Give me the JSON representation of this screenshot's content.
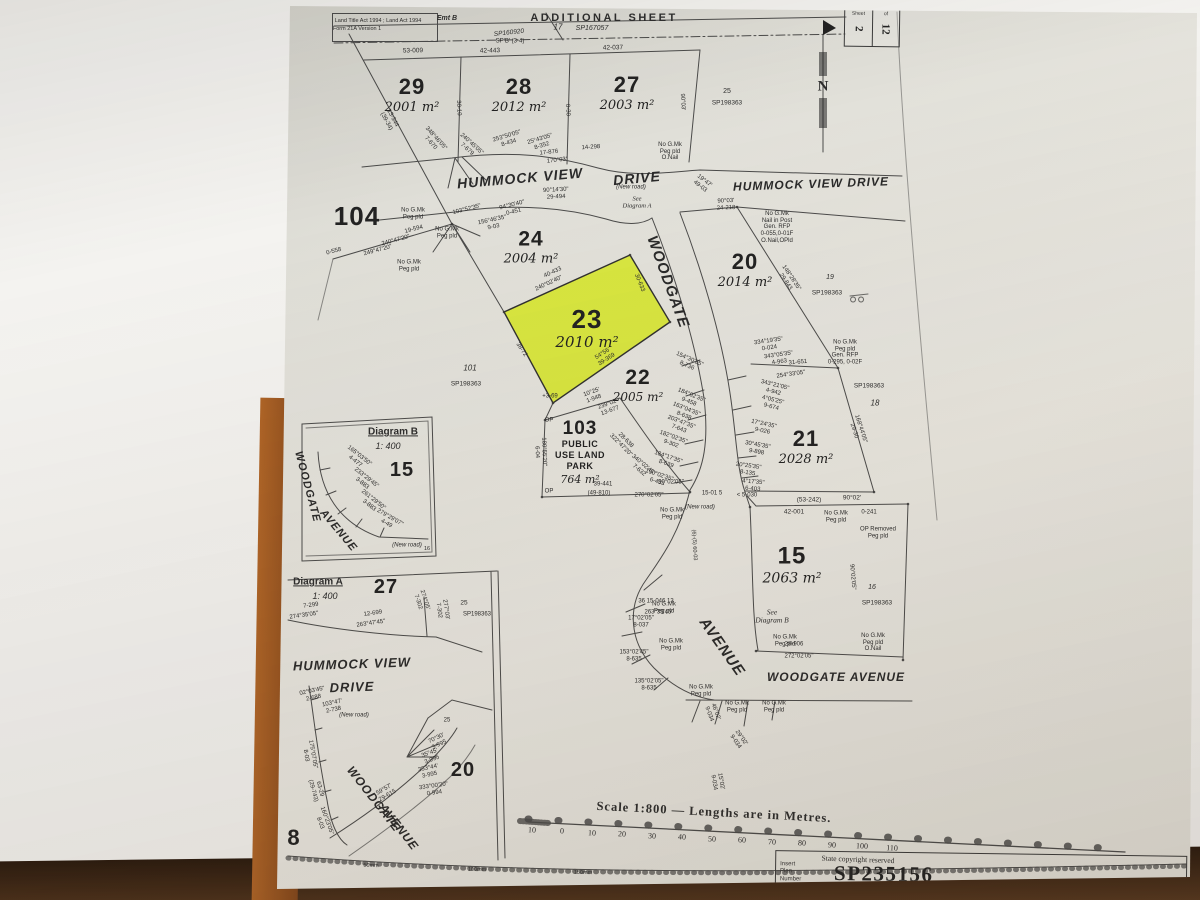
{
  "header": {
    "acts_line1": "Land Title Act 1994 ; Land Act 1994",
    "acts_line2": "Form 21A Version 1",
    "title": "ADDITIONAL SHEET"
  },
  "sheet_box": {
    "col1_label": "Sheet",
    "col1_value": "2",
    "col2_label": "of",
    "col2_value": "12"
  },
  "footer": {
    "copyright": "State copyright reserved",
    "insert_label_lines": [
      "Insert",
      "Plan",
      "Number"
    ],
    "plan_number": "SP235156"
  },
  "colors": {
    "highlight": "#d9e833",
    "paper": "#e4e2da",
    "ink": "#3a3a3a",
    "table": "#3b2414"
  },
  "lots": [
    {
      "num": "29",
      "area": "2001 m²",
      "x": 412,
      "y": 95,
      "ns": 22,
      "as": 13
    },
    {
      "num": "28",
      "area": "2012 m²",
      "x": 519,
      "y": 95,
      "ns": 22,
      "as": 13
    },
    {
      "num": "27",
      "area": "2003 m²",
      "x": 627,
      "y": 93,
      "ns": 22,
      "as": 13
    },
    {
      "num": "104",
      "x": 357,
      "y": 216,
      "ns": 26
    },
    {
      "num": "24",
      "area": "2004 m²",
      "x": 531,
      "y": 247,
      "ns": 21,
      "as": 13
    },
    {
      "num": "23",
      "area": "2010 m²",
      "x": 587,
      "y": 328,
      "ns": 26,
      "as": 15
    },
    {
      "num": "20",
      "area": "2014 m²",
      "x": 745,
      "y": 270,
      "ns": 22,
      "as": 13
    },
    {
      "num": "22",
      "area": "2005 m²",
      "x": 638,
      "y": 385,
      "ns": 21,
      "as": 12
    },
    {
      "num": "21",
      "area": "2028 m²",
      "x": 806,
      "y": 447,
      "ns": 22,
      "as": 13
    },
    {
      "num": "103",
      "sub": [
        "PUBLIC",
        "USE LAND",
        "PARK"
      ],
      "area": "764 m²",
      "x": 580,
      "y": 452,
      "ns": 19,
      "as": 11
    },
    {
      "num": "15",
      "area": "2063 m²",
      "x": 792,
      "y": 565,
      "ns": 24,
      "as": 14
    },
    {
      "num": "15",
      "x": 402,
      "y": 470,
      "ns": 20
    },
    {
      "num": "27",
      "x": 386,
      "y": 587,
      "ns": 20
    },
    {
      "num": "20",
      "x": 463,
      "y": 770,
      "ns": 20
    },
    {
      "num": "8",
      "x": 294,
      "y": 838,
      "ns": 22
    }
  ],
  "streets": [
    {
      "t": "HUMMOCK VIEW",
      "x": 520,
      "y": 178,
      "r": -5,
      "s": 14
    },
    {
      "t": "DRIVE",
      "x": 637,
      "y": 178,
      "r": -5,
      "s": 14
    },
    {
      "t": "HUMMOCK VIEW DRIVE",
      "x": 811,
      "y": 184,
      "r": -2,
      "s": 12
    },
    {
      "t": "WOODGATE",
      "x": 668,
      "y": 282,
      "r": 70,
      "s": 15
    },
    {
      "t": "AVENUE",
      "x": 722,
      "y": 647,
      "r": 55,
      "s": 15
    },
    {
      "t": "WOODGATE AVENUE",
      "x": 836,
      "y": 677,
      "r": 0,
      "s": 12
    },
    {
      "t": "WOODGATE",
      "x": 307,
      "y": 487,
      "r": 75,
      "s": 11
    },
    {
      "t": "AVENUE",
      "x": 338,
      "y": 531,
      "r": 50,
      "s": 11
    },
    {
      "t": "HUMMOCK VIEW",
      "x": 352,
      "y": 664,
      "r": -2,
      "s": 13
    },
    {
      "t": "DRIVE",
      "x": 352,
      "y": 687,
      "r": -2,
      "s": 13
    },
    {
      "t": "WOODGATE",
      "x": 374,
      "y": 799,
      "r": 52,
      "s": 12
    },
    {
      "t": "AVENUE",
      "x": 399,
      "y": 827,
      "r": 52,
      "s": 12
    }
  ],
  "annotations": [
    {
      "t": "Land Title Act 1994 ; Land Act 1994",
      "x": 378,
      "y": 21,
      "s": 5.5
    },
    {
      "t": "Form 21A Version 1",
      "x": 357,
      "y": 29,
      "s": 5.5
    },
    {
      "t": "Emt B",
      "x": 447,
      "y": 19,
      "s": 7,
      "i": 1,
      "b": 1
    },
    {
      "t": "SP160920",
      "x": 509,
      "y": 33,
      "s": 6.5,
      "i": 1,
      "r": -6
    },
    {
      "t": "SP'B' (3-4)",
      "x": 510,
      "y": 42,
      "s": 6
    },
    {
      "t": "ADDITIONAL SHEET",
      "x": 604,
      "y": 18,
      "s": 11,
      "b": 1,
      "ls": 2.5
    },
    {
      "t": "17",
      "x": 558,
      "y": 28,
      "s": 8,
      "i": 1
    },
    {
      "t": "SP167057",
      "x": 592,
      "y": 29,
      "s": 7,
      "i": 1
    },
    {
      "t": "N",
      "x": 823,
      "y": 87,
      "s": 15,
      "b": 1,
      "f": 1
    },
    {
      "t": "53-009",
      "x": 413,
      "y": 51,
      "s": 6.5,
      "r": -1
    },
    {
      "t": "42-443",
      "x": 490,
      "y": 51,
      "s": 6.5,
      "r": -1
    },
    {
      "t": "42-037",
      "x": 613,
      "y": 48,
      "s": 6.5,
      "r": -1
    },
    {
      "t": "13-344\n(39-34)",
      "x": 389,
      "y": 120,
      "s": 6,
      "r": 62
    },
    {
      "t": "30-10",
      "x": 458,
      "y": 108,
      "s": 6,
      "r": 87
    },
    {
      "t": "0-30",
      "x": 567,
      "y": 110,
      "s": 6,
      "r": 87
    },
    {
      "t": "90°03'",
      "x": 682,
      "y": 102,
      "s": 6,
      "r": 87
    },
    {
      "t": "348°46'05\"\n7-670",
      "x": 433,
      "y": 141,
      "s": 6,
      "r": 48
    },
    {
      "t": "240°45'05\"\n7-679",
      "x": 469,
      "y": 147,
      "s": 6,
      "r": 42
    },
    {
      "t": "253°50'05\"\n8-434",
      "x": 508,
      "y": 140,
      "s": 6,
      "r": -17
    },
    {
      "t": "25°43'05\"\n8-352",
      "x": 541,
      "y": 143,
      "s": 6,
      "r": -17
    },
    {
      "t": "17-876",
      "x": 549,
      "y": 153,
      "s": 6,
      "r": -6
    },
    {
      "t": "170°03'",
      "x": 557,
      "y": 161,
      "s": 6,
      "r": -6
    },
    {
      "t": "14-298",
      "x": 591,
      "y": 148,
      "s": 6,
      "r": -4
    },
    {
      "t": "No G.Mk\nPeg pld\nO.Nail",
      "x": 670,
      "y": 152,
      "s": 6
    },
    {
      "t": "19°47'\n49-03",
      "x": 702,
      "y": 184,
      "s": 6,
      "r": 38
    },
    {
      "t": "90°14'30\"\n29-494",
      "x": 556,
      "y": 194,
      "s": 6,
      "r": -3
    },
    {
      "t": "90°03'\n24-218",
      "x": 726,
      "y": 205,
      "s": 6,
      "r": -2
    },
    {
      "t": "No G.Mk\nNail in Post\nGen. RFP\n0-055,0-01F\nO.Nail,OPld",
      "x": 777,
      "y": 228,
      "s": 6
    },
    {
      "t": "No G.Mk\nPeg pld",
      "x": 413,
      "y": 214,
      "s": 6
    },
    {
      "t": "No G.Mk\nPeg pld",
      "x": 409,
      "y": 266,
      "s": 6
    },
    {
      "t": "No G.Mk\nPeg pld",
      "x": 447,
      "y": 233,
      "s": 6
    },
    {
      "t": "240°47'20\"",
      "x": 396,
      "y": 241,
      "s": 6,
      "r": -15
    },
    {
      "t": "249°47'20\"",
      "x": 378,
      "y": 251,
      "s": 6,
      "r": -15
    },
    {
      "t": "0-558",
      "x": 334,
      "y": 252,
      "s": 6,
      "r": -15
    },
    {
      "t": "19-594",
      "x": 414,
      "y": 230,
      "s": 6,
      "r": -15
    },
    {
      "t": "103°52'35\"",
      "x": 467,
      "y": 210,
      "s": 6,
      "r": -14
    },
    {
      "t": "94°30'40\"\n0-451",
      "x": 513,
      "y": 209,
      "s": 6,
      "r": -14
    },
    {
      "t": "156°46'35\"\n9-03",
      "x": 493,
      "y": 224,
      "s": 6,
      "r": -12
    },
    {
      "t": "25",
      "x": 727,
      "y": 92,
      "s": 7
    },
    {
      "t": "SP198363",
      "x": 727,
      "y": 103,
      "s": 6.5
    },
    {
      "t": "101",
      "x": 470,
      "y": 369,
      "s": 8,
      "i": 1
    },
    {
      "t": "SP198363",
      "x": 466,
      "y": 384,
      "s": 6.5
    },
    {
      "t": "19",
      "x": 830,
      "y": 278,
      "s": 7,
      "i": 1
    },
    {
      "t": "SP198363",
      "x": 827,
      "y": 293,
      "s": 6.5
    },
    {
      "t": "SP198363",
      "x": 869,
      "y": 386,
      "s": 6.5
    },
    {
      "t": "18",
      "x": 875,
      "y": 404,
      "s": 8,
      "i": 1
    },
    {
      "t": "16",
      "x": 872,
      "y": 588,
      "s": 7,
      "i": 1
    },
    {
      "t": "SP198363",
      "x": 877,
      "y": 603,
      "s": 6.5
    },
    {
      "t": "40-433",
      "x": 553,
      "y": 273,
      "s": 6,
      "r": -25
    },
    {
      "t": "240°02'40\"",
      "x": 549,
      "y": 284,
      "s": 6,
      "r": -25
    },
    {
      "t": "30-633",
      "x": 639,
      "y": 283,
      "s": 6,
      "r": 68
    },
    {
      "t": "38-72",
      "x": 521,
      "y": 350,
      "s": 6,
      "r": 56
    },
    {
      "t": "54°56'\n39-369",
      "x": 605,
      "y": 357,
      "s": 6,
      "r": -33
    },
    {
      "t": "148°28'35\"\n29-843",
      "x": 788,
      "y": 280,
      "s": 6,
      "r": 56
    },
    {
      "t": "334°19'35\"\n0-024",
      "x": 769,
      "y": 345,
      "s": 6,
      "r": -8
    },
    {
      "t": "343°05'35\"\n4-963",
      "x": 779,
      "y": 359,
      "s": 6,
      "r": -8
    },
    {
      "t": "31-651",
      "x": 798,
      "y": 363,
      "s": 6,
      "r": -5
    },
    {
      "t": "254°33'05\"",
      "x": 791,
      "y": 375,
      "s": 6,
      "r": -8
    },
    {
      "t": "343°21'05\"\n4-942",
      "x": 774,
      "y": 389,
      "s": 6,
      "r": 14
    },
    {
      "t": "4°05'25\"\n9-674",
      "x": 772,
      "y": 404,
      "s": 6,
      "r": 14
    },
    {
      "t": "17°24'35\"\n9-026",
      "x": 763,
      "y": 428,
      "s": 6,
      "r": 12
    },
    {
      "t": "30°45'35\"\n9-898",
      "x": 757,
      "y": 449,
      "s": 6,
      "r": 10
    },
    {
      "t": "20°25'35\"\n8-135",
      "x": 748,
      "y": 470,
      "s": 6,
      "r": 8
    },
    {
      "t": "4°17'35\"\n6-403",
      "x": 753,
      "y": 486,
      "s": 6,
      "r": 5
    },
    {
      "t": "168°44'05\"\n29-30",
      "x": 857,
      "y": 430,
      "s": 6,
      "r": 72
    },
    {
      "t": "No G.Mk\nPeg pld\nGen. RFP\n0-295, 0-02F",
      "x": 845,
      "y": 353,
      "s": 6
    },
    {
      "t": "154°30'35\"\n8-736",
      "x": 688,
      "y": 363,
      "s": 6,
      "r": 24
    },
    {
      "t": "184°02'35\"\n9-458",
      "x": 690,
      "y": 399,
      "s": 6,
      "r": 22
    },
    {
      "t": "163°04'35\"\n8-638",
      "x": 685,
      "y": 413,
      "s": 6,
      "r": 22
    },
    {
      "t": "203°47'35\"\n7-643",
      "x": 680,
      "y": 426,
      "s": 6,
      "r": 21
    },
    {
      "t": "182°02'35\"\n9-302",
      "x": 672,
      "y": 441,
      "s": 6,
      "r": 20
    },
    {
      "t": "184°17'35\"\n8-639",
      "x": 667,
      "y": 461,
      "s": 6,
      "r": 19
    },
    {
      "t": "190°02'35\"\n6-433",
      "x": 658,
      "y": 479,
      "s": 6,
      "r": 18
    },
    {
      "t": "10°25'\n1-948",
      "x": 593,
      "y": 396,
      "s": 6,
      "r": -20
    },
    {
      "t": "239°02'\n13-677",
      "x": 609,
      "y": 408,
      "s": 6,
      "r": -20
    },
    {
      "t": "+3-69",
      "x": 550,
      "y": 397,
      "s": 6
    },
    {
      "t": "28-638\n322°47'20\"",
      "x": 623,
      "y": 443,
      "s": 6,
      "r": 45
    },
    {
      "t": "340°02'45\"\n7-632",
      "x": 641,
      "y": 468,
      "s": 6,
      "r": 40
    },
    {
      "t": "180°55'20\"\n6-04",
      "x": 540,
      "y": 452,
      "s": 6,
      "r": 88
    },
    {
      "t": "OP",
      "x": 549,
      "y": 421,
      "s": 6
    },
    {
      "t": "OP",
      "x": 549,
      "y": 492,
      "s": 6
    },
    {
      "t": "39-441",
      "x": 603,
      "y": 485,
      "s": 6
    },
    {
      "t": "(49-810)",
      "x": 599,
      "y": 494,
      "s": 6
    },
    {
      "t": "270°02'05\"",
      "x": 649,
      "y": 496,
      "s": 6
    },
    {
      "t": "90°02'05\"",
      "x": 671,
      "y": 483,
      "s": 6
    },
    {
      "t": "15-01 5",
      "x": 712,
      "y": 494,
      "s": 6
    },
    {
      "t": "No G.Mk\nPeg pld",
      "x": 672,
      "y": 514,
      "s": 6
    },
    {
      "t": "(New road)",
      "x": 700,
      "y": 508,
      "s": 6,
      "i": 1
    },
    {
      "t": "< 5-030",
      "x": 747,
      "y": 496,
      "s": 6
    },
    {
      "t": "(53-242)",
      "x": 809,
      "y": 500,
      "s": 6.5
    },
    {
      "t": "90°02'",
      "x": 852,
      "y": 498,
      "s": 6.5
    },
    {
      "t": "42-001",
      "x": 794,
      "y": 512,
      "s": 6.5
    },
    {
      "t": "0-241",
      "x": 869,
      "y": 513,
      "s": 6
    },
    {
      "t": "No G.Mk\nPeg pld",
      "x": 836,
      "y": 517,
      "s": 6
    },
    {
      "t": "OP Removed\nPeg pld",
      "x": 878,
      "y": 533,
      "s": 6
    },
    {
      "t": "90°02'05\"",
      "x": 852,
      "y": 577,
      "s": 6,
      "r": 85
    },
    {
      "t": "(6)-(5) 60-03",
      "x": 694,
      "y": 545,
      "s": 5.5,
      "r": 87
    },
    {
      "t": "36 15-046 13",
      "x": 656,
      "y": 602,
      "s": 6
    },
    {
      "t": "263°33'45\"",
      "x": 659,
      "y": 613,
      "s": 6
    },
    {
      "t": "See\nDiagram B",
      "x": 772,
      "y": 617,
      "s": 7.5,
      "i": 1,
      "f": 1
    },
    {
      "t": "17°02'05\"\n8-037",
      "x": 641,
      "y": 622,
      "s": 6
    },
    {
      "t": "No G.Mk\nPeg pld",
      "x": 664,
      "y": 608,
      "s": 6
    },
    {
      "t": "No G.Mk\nPeg pld",
      "x": 671,
      "y": 645,
      "s": 6
    },
    {
      "t": "153°02'45\"\n8-635",
      "x": 634,
      "y": 656,
      "s": 6
    },
    {
      "t": "135°02'05\"\n8-635",
      "x": 649,
      "y": 685,
      "s": 6
    },
    {
      "t": "No G.Mk\nPeg pld",
      "x": 701,
      "y": 691,
      "s": 6
    },
    {
      "t": "No G.Mk\nPeg pld",
      "x": 737,
      "y": 707,
      "s": 6
    },
    {
      "t": "No G.Mk\nPeg pld",
      "x": 774,
      "y": 707,
      "s": 6
    },
    {
      "t": "46°02'\n9-034",
      "x": 712,
      "y": 713,
      "s": 6,
      "r": 70
    },
    {
      "t": "29°02'\n9-034",
      "x": 738,
      "y": 740,
      "s": 6,
      "r": 55
    },
    {
      "t": "15°02'\n9-034",
      "x": 717,
      "y": 782,
      "s": 6,
      "r": 80
    },
    {
      "t": "No G.Mk\nPeg pld",
      "x": 785,
      "y": 641,
      "s": 6
    },
    {
      "t": "28-906",
      "x": 794,
      "y": 645,
      "s": 6
    },
    {
      "t": "272°02'05\"",
      "x": 799,
      "y": 657,
      "s": 6
    },
    {
      "t": "No G.Mk\nPeg pld\nO.Nail",
      "x": 873,
      "y": 643,
      "s": 6
    },
    {
      "t": "Diagram B",
      "x": 393,
      "y": 432,
      "s": 10,
      "b": 1,
      "u": 1
    },
    {
      "t": "1: 400",
      "x": 388,
      "y": 446,
      "s": 9,
      "i": 1
    },
    {
      "t": "165°03'50\"\n4-477",
      "x": 357,
      "y": 459,
      "s": 6,
      "r": 38
    },
    {
      "t": "233°29'45\"\n3-883",
      "x": 364,
      "y": 481,
      "s": 6,
      "r": 38
    },
    {
      "t": "261°29'50\"\n3-883",
      "x": 371,
      "y": 503,
      "s": 6,
      "r": 38
    },
    {
      "t": "279°29'07\"\n4-49",
      "x": 388,
      "y": 521,
      "s": 6,
      "r": 30
    },
    {
      "t": "(New road)",
      "x": 407,
      "y": 546,
      "s": 6,
      "i": 1
    },
    {
      "t": "16",
      "x": 427,
      "y": 549,
      "s": 5.5
    },
    {
      "t": "Diagram A",
      "x": 318,
      "y": 582,
      "s": 10,
      "b": 1,
      "u": 1
    },
    {
      "t": "1: 400",
      "x": 325,
      "y": 596,
      "s": 9,
      "i": 1
    },
    {
      "t": "7-299",
      "x": 311,
      "y": 606,
      "s": 6,
      "r": -8
    },
    {
      "t": "274°35'05\"",
      "x": 304,
      "y": 616,
      "s": 6,
      "r": -8
    },
    {
      "t": "12-699",
      "x": 373,
      "y": 614,
      "s": 6,
      "r": -8
    },
    {
      "t": "263°47'45\"",
      "x": 371,
      "y": 624,
      "s": 6,
      "r": -8
    },
    {
      "t": "274°05'\n7-302",
      "x": 421,
      "y": 601,
      "s": 6,
      "r": 72
    },
    {
      "t": "277°03'\n7-302",
      "x": 442,
      "y": 610,
      "s": 6,
      "r": 82
    },
    {
      "t": "25",
      "x": 464,
      "y": 603,
      "s": 6.5
    },
    {
      "t": "SP198363",
      "x": 477,
      "y": 615,
      "s": 6
    },
    {
      "t": "02°03'45\"\n2-688",
      "x": 313,
      "y": 695,
      "s": 6,
      "r": -12
    },
    {
      "t": "103°47'\n2-738",
      "x": 333,
      "y": 707,
      "s": 6,
      "r": -12
    },
    {
      "t": "(New road)",
      "x": 354,
      "y": 716,
      "s": 6,
      "i": 1
    },
    {
      "t": "175°07'05\"\n8-03",
      "x": 309,
      "y": 755,
      "s": 6,
      "r": 80
    },
    {
      "t": "63-29\n(29-743)",
      "x": 316,
      "y": 790,
      "s": 6,
      "r": 75
    },
    {
      "t": "160°23'05\"\n8-03",
      "x": 323,
      "y": 822,
      "s": 6,
      "r": 70
    },
    {
      "t": "59°57'\n29-615",
      "x": 386,
      "y": 793,
      "s": 6,
      "r": -30
    },
    {
      "t": "25",
      "x": 447,
      "y": 721,
      "s": 6
    },
    {
      "t": "70°30'\n3-995",
      "x": 438,
      "y": 742,
      "s": 6,
      "r": -25
    },
    {
      "t": "35°45'\n3-995",
      "x": 431,
      "y": 757,
      "s": 6,
      "r": -20
    },
    {
      "t": "353°44'\n3-995",
      "x": 429,
      "y": 772,
      "s": 6,
      "r": -12
    },
    {
      "t": "333°00'20\"\n0-994",
      "x": 434,
      "y": 790,
      "s": 6,
      "r": -8
    },
    {
      "t": "(New road)",
      "x": 631,
      "y": 188,
      "s": 6,
      "i": 1
    },
    {
      "t": "See\nDiagram A",
      "x": 637,
      "y": 203,
      "s": 6.5,
      "i": 1,
      "f": 1
    },
    {
      "t": "Scale 1:800  —  Lengths are in Metres.",
      "x": 714,
      "y": 812,
      "s": 12.5,
      "b": 1,
      "f": 1,
      "r": 3,
      "ls": 1
    },
    {
      "t": "10",
      "x": 532,
      "y": 831,
      "s": 8,
      "f": 1,
      "r": 3
    },
    {
      "t": "0",
      "x": 562,
      "y": 832,
      "s": 8,
      "f": 1,
      "r": 3
    },
    {
      "t": "10",
      "x": 592,
      "y": 834,
      "s": 8,
      "f": 1,
      "r": 3
    },
    {
      "t": "20",
      "x": 622,
      "y": 835,
      "s": 8,
      "f": 1,
      "r": 3
    },
    {
      "t": "30",
      "x": 652,
      "y": 837,
      "s": 8,
      "f": 1,
      "r": 3
    },
    {
      "t": "40",
      "x": 682,
      "y": 838,
      "s": 8,
      "f": 1,
      "r": 3
    },
    {
      "t": "50",
      "x": 712,
      "y": 840,
      "s": 8,
      "f": 1,
      "r": 3
    },
    {
      "t": "60",
      "x": 742,
      "y": 841,
      "s": 8,
      "f": 1,
      "r": 3
    },
    {
      "t": "70",
      "x": 772,
      "y": 843,
      "s": 8,
      "f": 1,
      "r": 3
    },
    {
      "t": "80",
      "x": 802,
      "y": 844,
      "s": 8,
      "f": 1,
      "r": 3
    },
    {
      "t": "90",
      "x": 832,
      "y": 846,
      "s": 8,
      "f": 1,
      "r": 3
    },
    {
      "t": "100",
      "x": 862,
      "y": 847,
      "s": 8,
      "f": 1,
      "r": 3
    },
    {
      "t": "110",
      "x": 892,
      "y": 849,
      "s": 8,
      "f": 1,
      "r": 3
    },
    {
      "t": "State copyright reserved",
      "x": 858,
      "y": 860,
      "s": 7.5,
      "f": 1,
      "r": 2
    },
    {
      "t": "50mm",
      "x": 371,
      "y": 866,
      "s": 5.5,
      "r": 2
    },
    {
      "t": "100mm",
      "x": 477,
      "y": 870,
      "s": 5.5,
      "r": 1
    },
    {
      "t": "150mm",
      "x": 583,
      "y": 873,
      "s": 5.5,
      "r": 1
    }
  ]
}
